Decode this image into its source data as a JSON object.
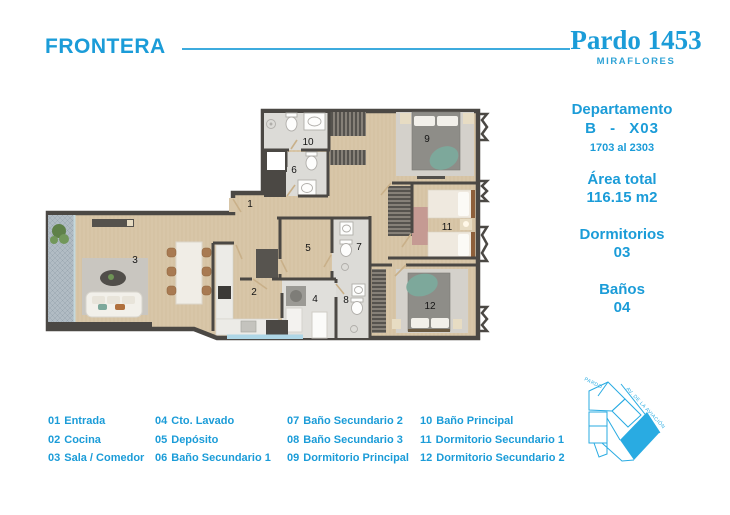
{
  "brand": {
    "name": "FRONTERA"
  },
  "project": {
    "name": "Pardo 1453",
    "district": "MIRAFLORES"
  },
  "unit": {
    "type_label": "Departamento",
    "type_value": "B - X03",
    "floors_range": "1703 al 2303",
    "area_label": "Área total",
    "area_value": "116.15 m2",
    "bedrooms_label": "Dormitorios",
    "bedrooms_value": "03",
    "bathrooms_label": "Baños",
    "bathrooms_value": "04"
  },
  "floorplan": {
    "room_numbers": [
      "1",
      "2",
      "3",
      "4",
      "5",
      "6",
      "7",
      "8",
      "9",
      "10",
      "11",
      "12"
    ]
  },
  "legend": {
    "columns": [
      {
        "items": [
          {
            "num": "01",
            "label": "Entrada"
          },
          {
            "num": "02",
            "label": "Cocina"
          },
          {
            "num": "03",
            "label": "Sala / Comedor"
          }
        ]
      },
      {
        "items": [
          {
            "num": "04",
            "label": "Cto. Lavado"
          },
          {
            "num": "05",
            "label": "Depósito"
          },
          {
            "num": "06",
            "label": "Baño Secundario 1"
          }
        ]
      },
      {
        "items": [
          {
            "num": "07",
            "label": "Baño Secundario 2"
          },
          {
            "num": "08",
            "label": "Baño Secundario 3"
          },
          {
            "num": "09",
            "label": "Dormitorio Principal"
          }
        ]
      },
      {
        "items": [
          {
            "num": "10",
            "label": "Baño Principal"
          },
          {
            "num": "11",
            "label": "Dormitorio Secundario 1"
          },
          {
            "num": "12",
            "label": "Dormitorio Secundario 2"
          }
        ]
      }
    ]
  },
  "siteplan": {
    "street_top": "PARDO",
    "street_right": "AV. DE LA AVIACIÓN"
  },
  "colors": {
    "accent": "#1b9cd8",
    "siteplan_blue": "#29abe2",
    "wall": "#4b4844",
    "wood_floor": "#d8c6a8",
    "bath_floor": "#dcdbd7",
    "teal_accent": "#7da89b"
  }
}
